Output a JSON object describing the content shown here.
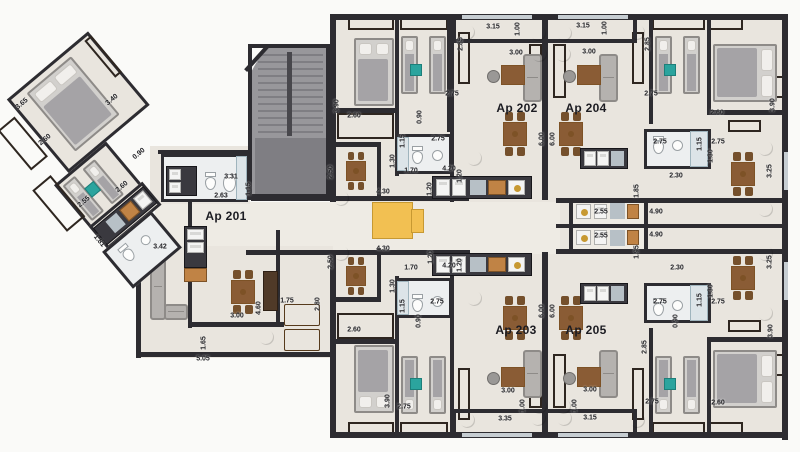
{
  "apartments": [
    {
      "label": "Ap 201",
      "x": 226,
      "y": 216
    },
    {
      "label": "Ap 202",
      "x": 517,
      "y": 108
    },
    {
      "label": "Ap 204",
      "x": 586,
      "y": 108
    },
    {
      "label": "Ap 203",
      "x": 516,
      "y": 330
    },
    {
      "label": "Ap 205",
      "x": 586,
      "y": 330
    }
  ],
  "dimensions": [
    {
      "t": "3.65",
      "x": 22,
      "y": 104,
      "r": -40
    },
    {
      "t": "3.40",
      "x": 112,
      "y": 100,
      "r": -40
    },
    {
      "t": "2.60",
      "x": 45,
      "y": 140,
      "r": -40
    },
    {
      "t": "0.90",
      "x": 139,
      "y": 154,
      "r": -40
    },
    {
      "t": "2.60",
      "x": 122,
      "y": 187,
      "r": -40
    },
    {
      "t": "2.55",
      "x": 84,
      "y": 202,
      "r": -40
    },
    {
      "t": "1.81",
      "x": 99,
      "y": 241,
      "r": 50
    },
    {
      "t": "3.42",
      "x": 160,
      "y": 247,
      "r": 0
    },
    {
      "t": "3.31",
      "x": 231,
      "y": 177,
      "r": 0
    },
    {
      "t": "2.63",
      "x": 221,
      "y": 196,
      "r": 0
    },
    {
      "t": "1.15",
      "x": 249,
      "y": 189,
      "r": -90
    },
    {
      "t": "2.50",
      "x": 331,
      "y": 172,
      "r": -90
    },
    {
      "t": "2.50",
      "x": 331,
      "y": 262,
      "r": -90
    },
    {
      "t": "3.00",
      "x": 237,
      "y": 316,
      "r": 0
    },
    {
      "t": "4.60",
      "x": 259,
      "y": 308,
      "r": -90
    },
    {
      "t": "1.65",
      "x": 204,
      "y": 343,
      "r": -90
    },
    {
      "t": "5.05",
      "x": 203,
      "y": 359,
      "r": 0
    },
    {
      "t": "1.75",
      "x": 287,
      "y": 301,
      "r": 0
    },
    {
      "t": "2.80",
      "x": 318,
      "y": 304,
      "r": -90
    },
    {
      "t": "3.90",
      "x": 337,
      "y": 106,
      "r": -90
    },
    {
      "t": "2.60",
      "x": 354,
      "y": 116,
      "r": 0
    },
    {
      "t": "0.90",
      "x": 420,
      "y": 117,
      "r": -90
    },
    {
      "t": "2.75",
      "x": 452,
      "y": 94,
      "r": 0
    },
    {
      "t": "2.85",
      "x": 461,
      "y": 44,
      "r": -90
    },
    {
      "t": "3.15",
      "x": 493,
      "y": 27,
      "r": 0
    },
    {
      "t": "1.00",
      "x": 518,
      "y": 29,
      "r": -90
    },
    {
      "t": "3.00",
      "x": 516,
      "y": 53,
      "r": 0
    },
    {
      "t": "1.15",
      "x": 403,
      "y": 141,
      "r": -90
    },
    {
      "t": "2.75",
      "x": 438,
      "y": 139,
      "r": 0
    },
    {
      "t": "1.30",
      "x": 393,
      "y": 161,
      "r": -90
    },
    {
      "t": "1.70",
      "x": 411,
      "y": 171,
      "r": 0
    },
    {
      "t": "4.20",
      "x": 449,
      "y": 169,
      "r": 0
    },
    {
      "t": "1.20",
      "x": 460,
      "y": 176,
      "r": -90
    },
    {
      "t": "1.20",
      "x": 430,
      "y": 189,
      "r": -90
    },
    {
      "t": "4.30",
      "x": 383,
      "y": 192,
      "r": 0
    },
    {
      "t": "3.15",
      "x": 583,
      "y": 26,
      "r": 0
    },
    {
      "t": "1.00",
      "x": 605,
      "y": 28,
      "r": -90
    },
    {
      "t": "3.00",
      "x": 589,
      "y": 52,
      "r": 0
    },
    {
      "t": "2.85",
      "x": 648,
      "y": 44,
      "r": -90
    },
    {
      "t": "2.75",
      "x": 651,
      "y": 94,
      "r": 0
    },
    {
      "t": "2.60",
      "x": 717,
      "y": 113,
      "r": 0
    },
    {
      "t": "3.90",
      "x": 773,
      "y": 105,
      "r": -90
    },
    {
      "t": "2.75",
      "x": 660,
      "y": 142,
      "r": 0
    },
    {
      "t": "1.15",
      "x": 700,
      "y": 144,
      "r": -90
    },
    {
      "t": "2.75",
      "x": 718,
      "y": 142,
      "r": 0
    },
    {
      "t": "1.30",
      "x": 711,
      "y": 156,
      "r": -90
    },
    {
      "t": "2.30",
      "x": 676,
      "y": 176,
      "r": 0
    },
    {
      "t": "1.85",
      "x": 637,
      "y": 191,
      "r": -90
    },
    {
      "t": "3.25",
      "x": 770,
      "y": 171,
      "r": -90
    },
    {
      "t": "2.55",
      "x": 601,
      "y": 212,
      "r": 0
    },
    {
      "t": "4.90",
      "x": 656,
      "y": 212,
      "r": 0
    },
    {
      "t": "2.55",
      "x": 601,
      "y": 236,
      "r": 0
    },
    {
      "t": "4.90",
      "x": 656,
      "y": 235,
      "r": 0
    },
    {
      "t": "1.95",
      "x": 637,
      "y": 252,
      "r": -90
    },
    {
      "t": "3.25",
      "x": 770,
      "y": 262,
      "r": -90
    },
    {
      "t": "2.30",
      "x": 677,
      "y": 268,
      "r": 0
    },
    {
      "t": "1.30",
      "x": 711,
      "y": 291,
      "r": -90
    },
    {
      "t": "2.75",
      "x": 660,
      "y": 302,
      "r": 0
    },
    {
      "t": "1.15",
      "x": 700,
      "y": 300,
      "r": -90
    },
    {
      "t": "2.75",
      "x": 718,
      "y": 302,
      "r": 0
    },
    {
      "t": "6.00",
      "x": 542,
      "y": 139,
      "r": -90
    },
    {
      "t": "6.00",
      "x": 553,
      "y": 139,
      "r": -90
    },
    {
      "t": "6.00",
      "x": 542,
      "y": 311,
      "r": -90
    },
    {
      "t": "6.00",
      "x": 553,
      "y": 311,
      "r": -90
    },
    {
      "t": "4.30",
      "x": 383,
      "y": 249,
      "r": 0
    },
    {
      "t": "1.20",
      "x": 431,
      "y": 257,
      "r": -90
    },
    {
      "t": "1.70",
      "x": 411,
      "y": 268,
      "r": 0
    },
    {
      "t": "4.20",
      "x": 449,
      "y": 266,
      "r": 0
    },
    {
      "t": "1.20",
      "x": 460,
      "y": 265,
      "r": -90
    },
    {
      "t": "1.30",
      "x": 393,
      "y": 286,
      "r": -90
    },
    {
      "t": "1.15",
      "x": 403,
      "y": 306,
      "r": -90
    },
    {
      "t": "2.75",
      "x": 437,
      "y": 302,
      "r": 0
    },
    {
      "t": "0.90",
      "x": 419,
      "y": 321,
      "r": -90
    },
    {
      "t": "2.60",
      "x": 354,
      "y": 330,
      "r": 0
    },
    {
      "t": "3.90",
      "x": 388,
      "y": 401,
      "r": -90
    },
    {
      "t": "2.75",
      "x": 404,
      "y": 407,
      "r": 0
    },
    {
      "t": "3.00",
      "x": 508,
      "y": 391,
      "r": 0
    },
    {
      "t": "1.00",
      "x": 523,
      "y": 406,
      "r": -90
    },
    {
      "t": "3.35",
      "x": 505,
      "y": 419,
      "r": 0
    },
    {
      "t": "3.00",
      "x": 590,
      "y": 390,
      "r": 0
    },
    {
      "t": "1.00",
      "x": 575,
      "y": 406,
      "r": -90
    },
    {
      "t": "3.15",
      "x": 590,
      "y": 418,
      "r": 0
    },
    {
      "t": "0.90",
      "x": 676,
      "y": 321,
      "r": -90
    },
    {
      "t": "2.85",
      "x": 645,
      "y": 347,
      "r": -90
    },
    {
      "t": "2.75",
      "x": 652,
      "y": 402,
      "r": 0
    },
    {
      "t": "2.60",
      "x": 718,
      "y": 403,
      "r": 0
    },
    {
      "t": "3.90",
      "x": 771,
      "y": 331,
      "r": -90
    }
  ],
  "colors": {
    "bg": "#fafaf8",
    "floor": "#e9e5de",
    "floorLight": "#eeebe4",
    "bath": "#edeff0",
    "wall": "#2d2c31",
    "wood": "#c08345",
    "woodDark": "#7d5226",
    "deckBg": "#2e2620",
    "stair": "#98979b",
    "stairDark": "#7f7e83",
    "rail": "#48474c",
    "yellow": "#f2c052",
    "yellowDark": "#c79932",
    "plant": "#53973f",
    "plantDark": "#2c5e26",
    "sofa": "#b5b2af",
    "sofaDark": "#8e8b88",
    "bedBase": "#d2d0cd",
    "blanket": "#a5a3a6",
    "pillow": "#f1efec",
    "tableWood": "#8a5c35",
    "chairWood": "#75502c",
    "counter": "#3a393f",
    "appl": "#f4f4f3",
    "applEdge": "#b0b0ae",
    "steel": "#b7c0c6",
    "teal": "#2ba49e",
    "text": "#222226",
    "win": "#c6cdd2"
  }
}
